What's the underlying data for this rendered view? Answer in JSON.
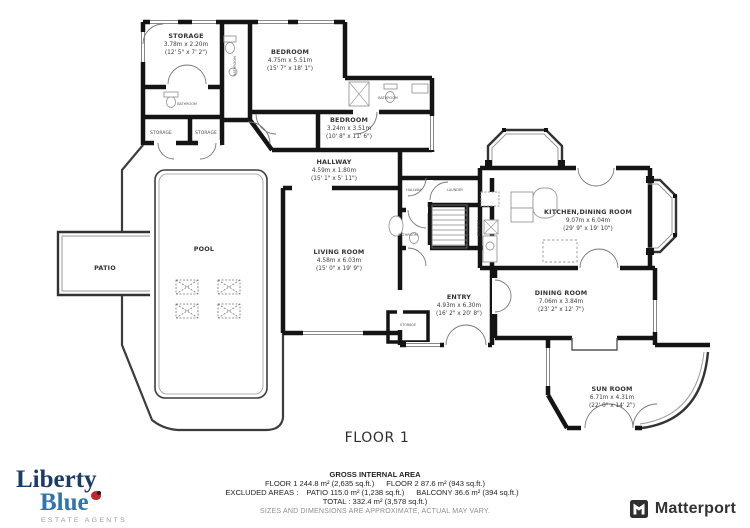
{
  "floor_label": "FLOOR 1",
  "rooms": {
    "storage_main": {
      "name": "STORAGE",
      "metric": "3.78m x 2.20m",
      "imperial": "(12' 5\" x 7' 2\")"
    },
    "bedroom1": {
      "name": "BEDROOM",
      "metric": "4.75m x 5.51m",
      "imperial": "(15' 7\" x 18' 1\")"
    },
    "bedroom2": {
      "name": "BEDROOM",
      "metric": "3.24m x 3.51m",
      "imperial": "(10' 8\" x 11' 6\")"
    },
    "hallway": {
      "name": "HALLWAY",
      "metric": "4.59m x 1.80m",
      "imperial": "(15' 1\" x 5' 11\")"
    },
    "living_room": {
      "name": "LIVING ROOM",
      "metric": "4.58m x 6.03m",
      "imperial": "(15' 0\" x 19' 9\")"
    },
    "entry": {
      "name": "ENTRY",
      "metric": "4.93m x 6.30m",
      "imperial": "(16' 2\" x 20' 8\")"
    },
    "kitchen_dining": {
      "name": "KITCHEN,DINING ROOM",
      "metric": "9.07m x 6.04m",
      "imperial": "(29' 9\" x 19' 10\")"
    },
    "dining_room": {
      "name": "DINING ROOM",
      "metric": "7.06m x 3.84m",
      "imperial": "(23' 2\" x 12' 7\")"
    },
    "sun_room": {
      "name": "SUN ROOM",
      "metric": "6.71m x 4.31m",
      "imperial": "(22' 0\" x 14' 2\")"
    },
    "patio": {
      "name": "PATIO"
    },
    "pool": {
      "name": "POOL"
    }
  },
  "small_labels": {
    "bathroom_storage": "BATHROOM",
    "storage_left": "STORAGE",
    "storage_right": "STORAGE",
    "bathroom_strip": "BATHROOM",
    "bathroom_ensuite": "BATHROOM",
    "hallway_small": "HALLWAY",
    "laundry": "LAUNDRY",
    "storage_stairs": "STORAGE",
    "bathroom_utility": "BATHROOM",
    "storage_entry": "STORAGE"
  },
  "footer": {
    "gross_title": "GROSS INTERNAL AREA",
    "floor1": "FLOOR 1 244.8 m² (2,635 sq.ft.)",
    "floor2": "FLOOR 2 87.6 m² (943 sq.ft.)",
    "excluded_label": "EXCLUDED AREAS :",
    "patio_area": "PATIO 115.0 m² (1,238 sq.ft.)",
    "balcony_area": "BALCONY 36.6 m² (394 sq.ft.)",
    "total": "TOTAL :  332.4 m² (3,578 sq.ft.)",
    "disclaimer": "SIZES AND DIMENSIONS ARE APPROXIMATE, ACTUAL MAY VARY."
  },
  "branding": {
    "liberty": "Liberty",
    "blue": "Blue",
    "tagline": "ESTATE AGENTS",
    "matterport": "Matterport"
  },
  "colors": {
    "wall": "#141414",
    "thin_line": "#555555",
    "liberty_navy": "#1d3c63",
    "liberty_blue": "#2f74ad",
    "ladybug_red": "#c1272d",
    "matterport_dark": "#333333"
  }
}
